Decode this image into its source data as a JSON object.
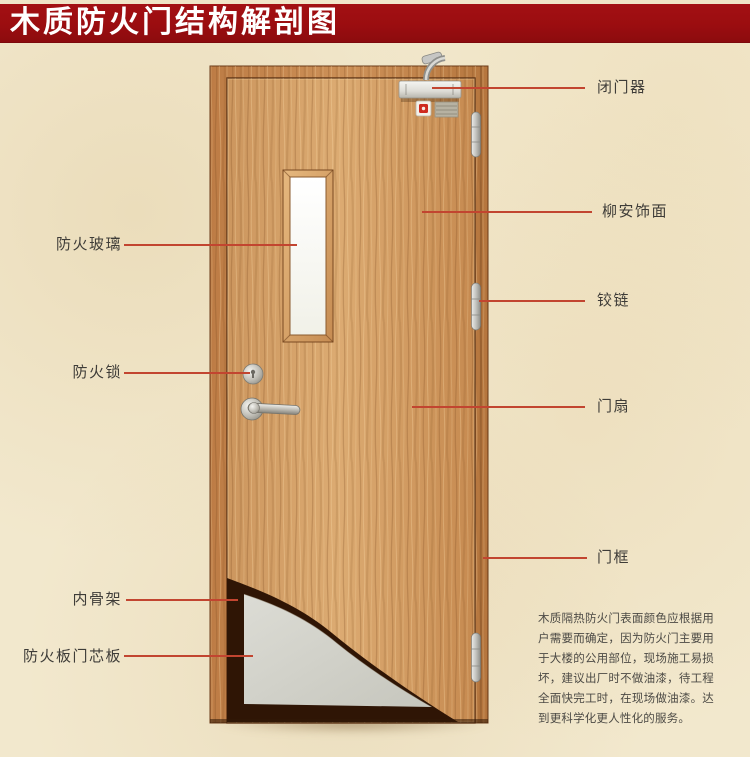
{
  "banner": {
    "title": "木质防火门结构解剖图"
  },
  "callouts": {
    "left": [
      {
        "label": "防火玻璃"
      },
      {
        "label": "防火锁"
      },
      {
        "label": "内骨架"
      },
      {
        "label": "防火板门芯板"
      }
    ],
    "right": [
      {
        "label": "闭门器"
      },
      {
        "label": "柳安饰面"
      },
      {
        "label": "铰链"
      },
      {
        "label": "门扇"
      },
      {
        "label": "门框"
      }
    ]
  },
  "description": "木质隔热防火门表面颜色应根据用户需要而确定，因为防火门主要用于大楼的公用部位，现场施工易损坏，建议出厂时不做油漆，待工程全面快完工时，在现场做油漆。达到更科学化更人性化的服务。",
  "colors": {
    "banner_red": "#9b0d10",
    "callout_red": "#c24530",
    "door_wood": "#cf9a62",
    "frame_wood": "#c08049",
    "core_panel_gray": "#d3d3cb",
    "inner_skeleton_brown": "#2f1505",
    "background_beige": "#f2e8cd",
    "glass_white": "#fbfbf6"
  }
}
